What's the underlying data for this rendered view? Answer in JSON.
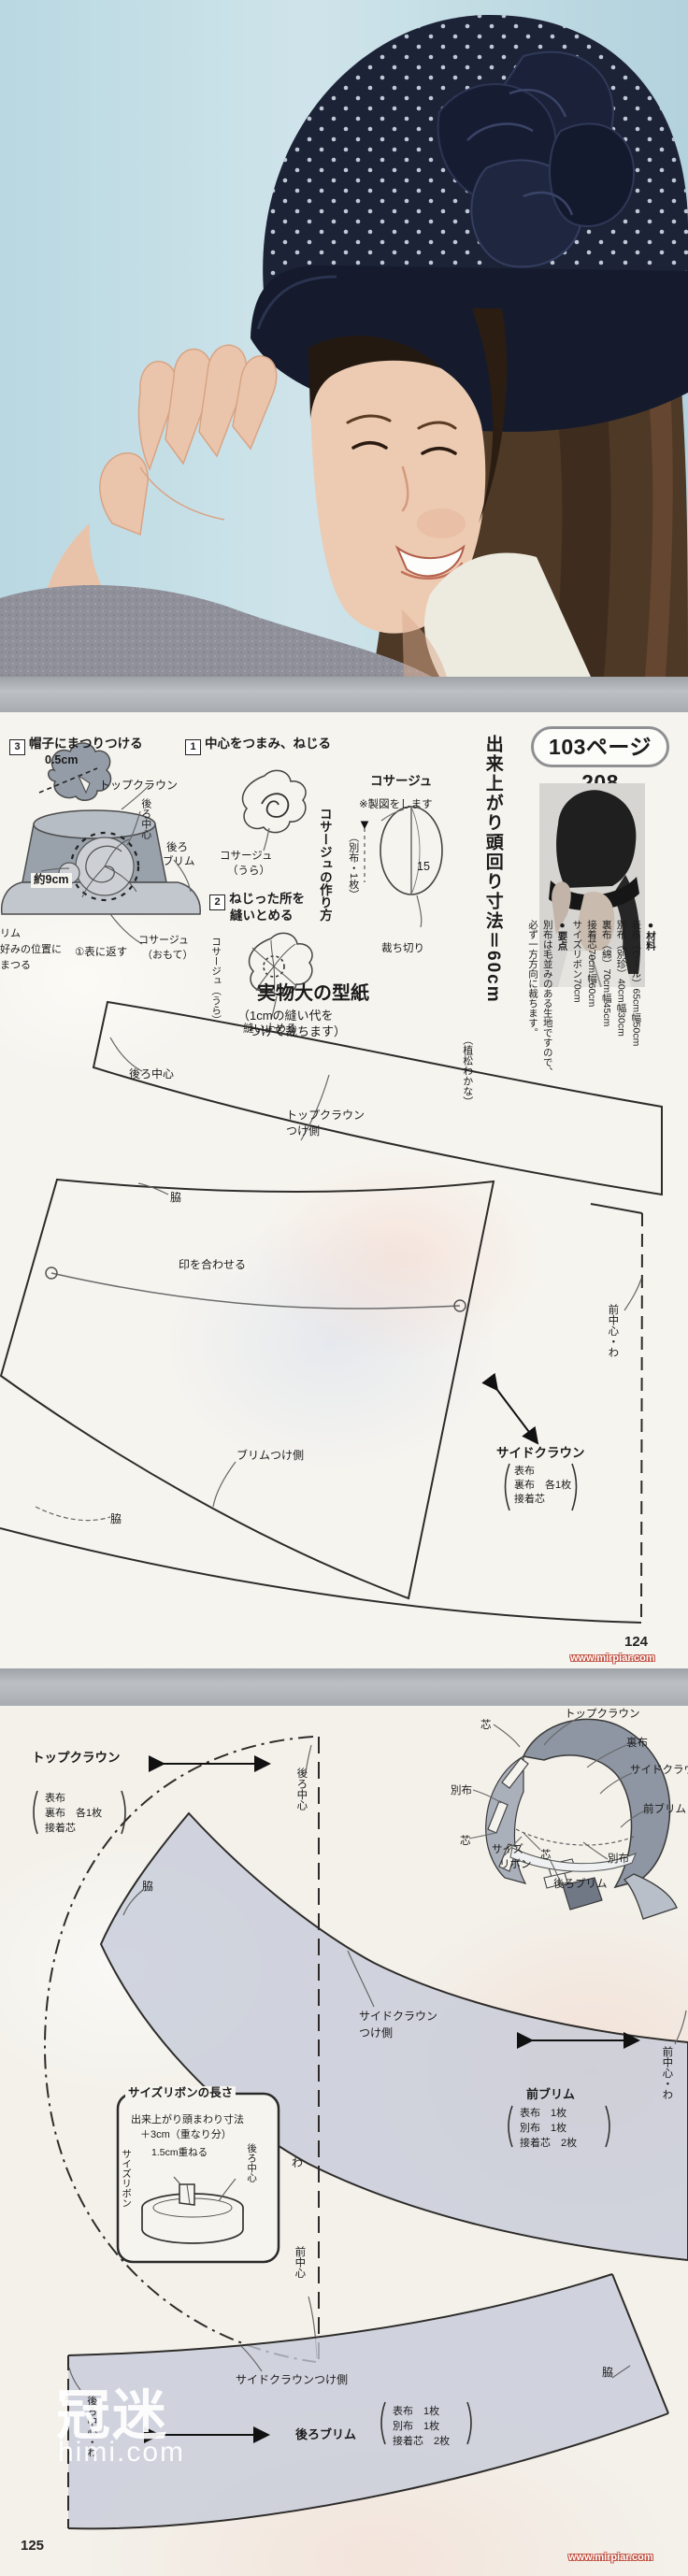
{
  "colors": {
    "hat_navy": "#1c2337",
    "photo_bg": "#bedbe4",
    "pattern_fill": "#c5cad8",
    "page_bg": "#f5f3ee"
  },
  "page124": {
    "pill": "103ページ208",
    "headline": "出来上がり頭回り寸法＝60cm",
    "materials": {
      "title": "●材料",
      "m1": "表布（ウール）65cm幅50cm",
      "m2": "別布（別珍）40cm幅30cm",
      "m3": "裏布（綿）70cm幅45cm",
      "m4": "接着芯70cm幅60cm",
      "m5": "サイズリボン70cm",
      "notes_title": "●要点",
      "n1": "別布は毛並みのある生地ですので、",
      "n2": "必ず一方方向に裁ちます。"
    },
    "step1": {
      "num": "1",
      "title": "中心をつまみ、ねじる",
      "cap1": "コサージュ",
      "cap2": "（うら）"
    },
    "step2": {
      "num": "2",
      "title1": "ねじった所を",
      "title2": "縫いとめる",
      "side": "コサージュ（うら）",
      "cap": "縫い止める"
    },
    "step3": {
      "num": "3",
      "title": "帽子にまつりつける",
      "d1": "0.5cm",
      "d2": "トップクラウン",
      "d3": "後ろ中心",
      "d4": "後ろ",
      "d5": "ブリム",
      "d6": "約9cm",
      "d7": "リム",
      "d8": "好みの位置に",
      "d9": "まつる",
      "d10": "①表に返す",
      "d11": "コサージュ",
      "d12": "（おもて）"
    },
    "howto": "コサージュの作り方",
    "draft": {
      "title": "コサージュ",
      "note": "※製図をします",
      "fabric": "（別布・1枚）",
      "dim": "15",
      "cut": "裁ち切り"
    },
    "pattern": {
      "title": "実物大の型紙",
      "sub1": "（1cmの縫い代を",
      "sub2": "つけて裁ちます）",
      "designer": "（植松わかな）",
      "back_center": "後ろ中心",
      "attach1": "トップクラウン",
      "attach2": "つけ側",
      "waki1": "脇",
      "match": "印を合わせる",
      "brim_side": "ブリムつけ側",
      "front_fold": "前中心・わ",
      "piece": "サイドクラウン",
      "p1": "表布",
      "p2": "裏布　各1枚",
      "p3": "接着芯",
      "waki2": "脇"
    },
    "page_no": "124",
    "site": "www.mirpiar.com"
  },
  "page125": {
    "topcrown": {
      "name": "トップクラウン",
      "p1": "表布",
      "p2": "裏布　各1枚",
      "p3": "接着芯",
      "back_center": "後ろ中心",
      "fold": "わ",
      "front_center": "前中心"
    },
    "hat": {
      "core1": "芯",
      "topcrown": "トップクラウン",
      "lining": "裏布",
      "sidecrown": "サイドクラウン",
      "contrast1": "別布",
      "frontbrim": "前ブリム",
      "core2": "芯",
      "size1": "サイズ",
      "size2": "リボン",
      "core3": "芯",
      "contrast2": "別布",
      "backbrim": "後ろブリム"
    },
    "frontbrim": {
      "waki": "脇",
      "attach1": "サイドクラウン",
      "attach2": "つけ側",
      "name": "前ブリム",
      "p1": "表布　1枚",
      "p2": "別布　1枚",
      "p3": "接着芯　2枚",
      "front_fold": "前中心・わ"
    },
    "box": {
      "title": "サイズリボンの長さ",
      "l1": "出来上がり頭まわり寸法",
      "l2": "＋3cm（重なり分）",
      "overlap": "1.5cm重ねる",
      "back_center": "後ろ中心",
      "ribbon": "サイズリボン"
    },
    "backbrim": {
      "waki": "脇",
      "attach": "サイドクラウンつけ側",
      "name": "後ろブリム",
      "p1": "表布　1枚",
      "p2": "別布　1枚",
      "p3": "接着芯　2枚",
      "back_fold": "後ろ中心・わ"
    },
    "watermark1": "冠迷",
    "watermark2": "himi.com",
    "page_no": "125",
    "site": "www.mirpiar.com"
  }
}
